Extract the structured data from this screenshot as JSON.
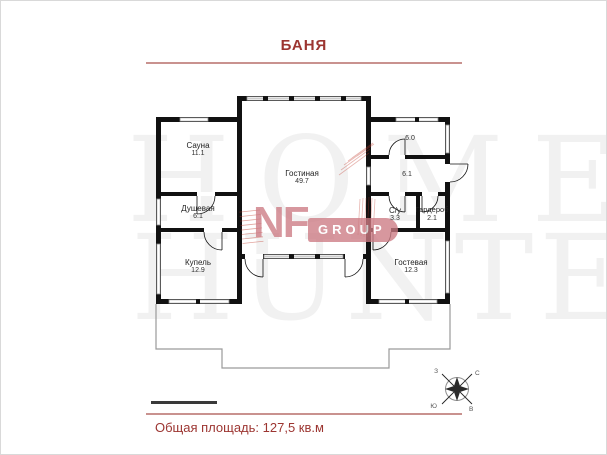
{
  "title": "БАНЯ",
  "plan": {
    "rooms": [
      {
        "name": "Сауна",
        "area": "11.1"
      },
      {
        "name": "Душевая",
        "area": "6.1"
      },
      {
        "name": "Купель",
        "area": "12.9"
      },
      {
        "name": "Гостиная",
        "area": "49.7"
      },
      {
        "name": "",
        "area": "6.0"
      },
      {
        "name": "",
        "area": "6.1"
      },
      {
        "name": "С/у",
        "area": "3.3"
      },
      {
        "name": "Гардероб",
        "area": "2.1"
      },
      {
        "name": "Гостевая",
        "area": "12.3"
      }
    ]
  },
  "watermark": {
    "line1": "HOME",
    "line2": "HUNTER",
    "nf": "NF",
    "group": "GROUP"
  },
  "compass": {
    "n": "С",
    "s": "Ю",
    "w": "З",
    "e": "В"
  },
  "footer": {
    "total_area": "Общая площадь: 127,5 кв.м"
  },
  "colors": {
    "accent": "#9c3531",
    "rule": "#c9928f",
    "logo_pink": "#cd7b84",
    "wall": "#111111"
  }
}
